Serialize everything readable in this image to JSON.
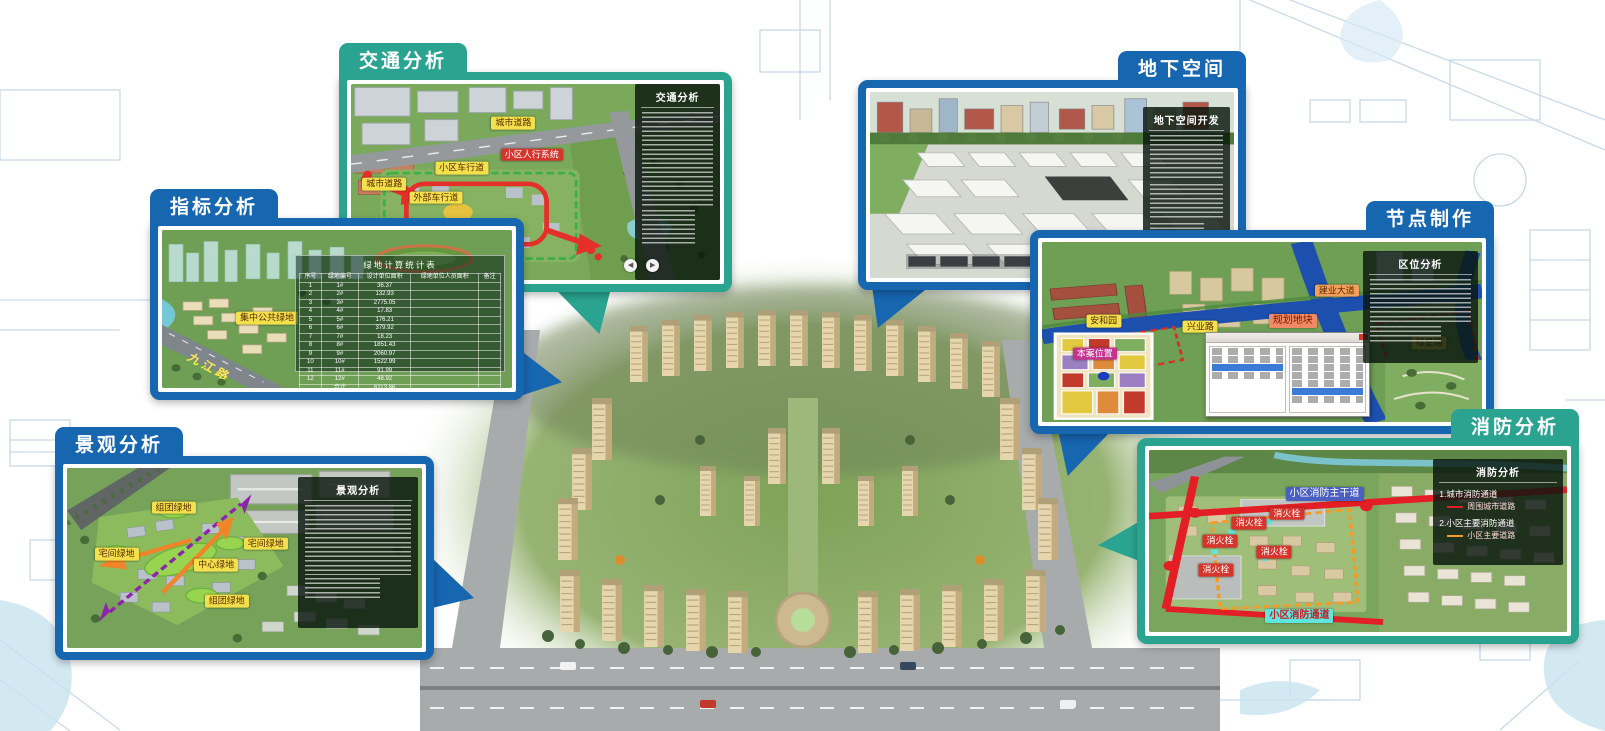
{
  "colors": {
    "teal": "#2aa490",
    "blue": "#1766b0",
    "chip_yellow": "#f2e04c",
    "chip_red": "#d6352b",
    "chip_salmon": "#ef8a64",
    "chip_orange": "#f2a05c",
    "chip_magenta": "#c5338f",
    "chip_blue": "#4a5fc0",
    "chip_cyan": "#5fe6df",
    "road_red": "#e31e24",
    "route_orange": "#f59a23"
  },
  "panels": {
    "traffic": {
      "tab": "交通分析",
      "sidebar_title": "交通分析",
      "labels": {
        "road_top": "城市道路",
        "pedestrian_system": "小区人行系统",
        "community_driveway": "小区车行道",
        "city_road": "城市道路",
        "external_driveway": "外部车行道"
      }
    },
    "indicator": {
      "tab": "指标分析",
      "green_label": "集中公共绿地",
      "road_name": "九江路",
      "table": {
        "title": "绿地计算统计表",
        "headers": [
          "序号",
          "绿地编号",
          "设计单位面积",
          "绿地单位人员面积",
          "备注"
        ],
        "rows": [
          [
            "1",
            "1#",
            "36.37",
            "",
            ""
          ],
          [
            "2",
            "2#",
            "132.93",
            "",
            ""
          ],
          [
            "3",
            "3#",
            "2775.05",
            "",
            ""
          ],
          [
            "4",
            "4#",
            "17.83",
            "",
            ""
          ],
          [
            "5",
            "5#",
            "176.21",
            "",
            ""
          ],
          [
            "6",
            "6#",
            "379.92",
            "",
            ""
          ],
          [
            "7",
            "7#",
            "18.23",
            "",
            ""
          ],
          [
            "8",
            "8#",
            "1851.43",
            "",
            ""
          ],
          [
            "9",
            "9#",
            "2060.97",
            "",
            ""
          ],
          [
            "10",
            "10#",
            "1522.99",
            "",
            ""
          ],
          [
            "11",
            "11#",
            "91.99",
            "",
            ""
          ],
          [
            "12",
            "12#",
            "48.92",
            "",
            ""
          ]
        ],
        "total_row": [
          "",
          "合计",
          "6113.86",
          "",
          ""
        ],
        "note": "注：绿地编号标注详见上图，各地块绿地编号与计算面积对应。"
      }
    },
    "underground": {
      "tab": "地下空间",
      "sidebar_title": "地下空间开发"
    },
    "node": {
      "tab": "节点制作",
      "sidebar_title": "区位分析",
      "labels": {
        "anhe_garden": "安和园",
        "xingye_road": "兴业路",
        "planned_plot": "规划地块",
        "jianye_avenue": "建业大道",
        "luxing_road": "禄星路",
        "site_location": "本案位置"
      }
    },
    "landscape": {
      "tab": "景观分析",
      "sidebar_title": "景观分析",
      "labels": {
        "group_green_top": "组团绿地",
        "house_green_left": "宅间绿地",
        "central_green": "中心绿地",
        "house_green_right": "宅间绿地",
        "group_green_bottom": "组团绿地"
      }
    },
    "fire": {
      "tab": "消防分析",
      "sidebar_title": "消防分析",
      "legend": [
        {
          "item": "1.城市消防通道",
          "swatch_color": "#e31e24",
          "swatch_label": "周围城市道路"
        },
        {
          "item": "2.小区主要消防通道",
          "swatch_color": "#f59a23",
          "swatch_label": "小区主要道路"
        }
      ],
      "labels": {
        "main_fire_road": "小区消防主干道",
        "hydrant": "消火栓",
        "community_fire_road": "小区消防通道"
      }
    }
  }
}
